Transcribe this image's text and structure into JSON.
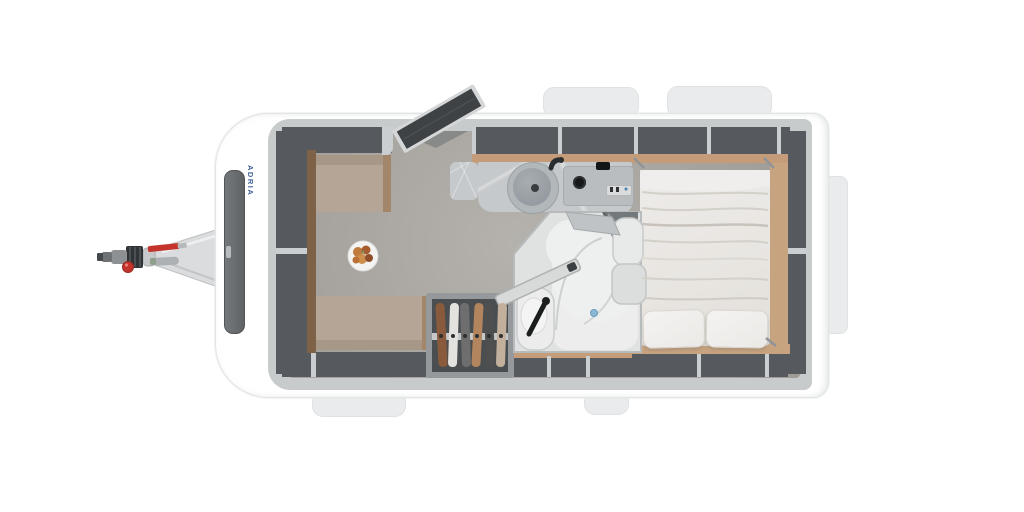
{
  "description": "Top-down 3D render of a single-axle caravan floor plan: tow hitch at left, front U-shaped dinette with marble table and breakfast plate, mid kitchen with round sink and hob, open entry door at top, corner bathroom with shower and toilet, open wardrobe with hanging clothes, and a transverse double bed with two pillows at the rear, surrounded by open storage lockers",
  "brand": {
    "text": "ADRIA",
    "color": "#41639a"
  },
  "palette": {
    "background": "#ffffff",
    "body_shell": "#ffffff",
    "exterior_flap": "#e9ebec",
    "interior_wall": "#c8cbcc",
    "floor": "#a8a49f",
    "storage_locker_dark": "#565a5e",
    "locker_divider": "#cbced0",
    "wood_shelf_tan": "#c49c7a",
    "wood_trim": "#a3866a",
    "bench_upholstery": "#b4a597",
    "worktop_marble": "#c6c9cb",
    "table_marble": "#b4bbc1",
    "mattress_white": "#e9e6e2",
    "bathroom_floor": "#e0e2e2",
    "door_leaf_dark": "#3e4245",
    "hitch_metal": "#dadcdd",
    "hitch_red": "#c5342c",
    "drain_blue": "#8ab8d6",
    "front_window_dark": "#696d70"
  },
  "features": [
    "tow-hitch",
    "front-window",
    "brand-logo-text",
    "u-shaped-dinette",
    "dining-table",
    "breakfast-plate",
    "kitchen-counter",
    "round-sink",
    "faucet",
    "hob-with-knobs",
    "overhead-lockers",
    "entry-door-open",
    "window-flaps",
    "wardrobe-with-clothes",
    "bathroom",
    "shower",
    "toilet",
    "toilet-brush",
    "bathroom-door",
    "double-bed",
    "pillows",
    "underbed-storage"
  ]
}
